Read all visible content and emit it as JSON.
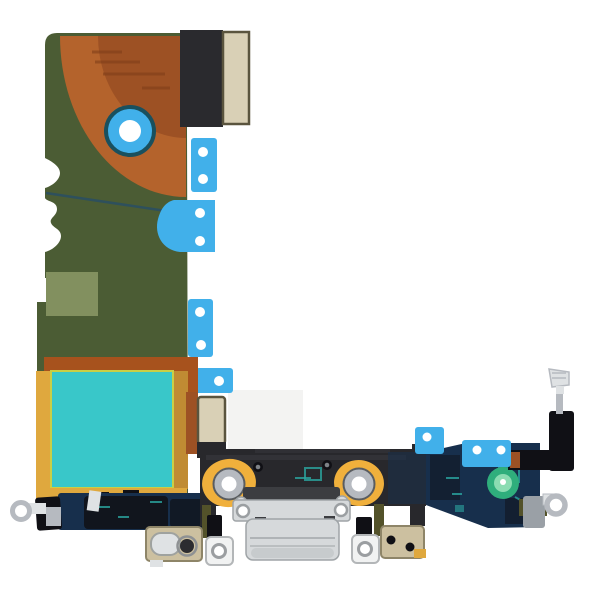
{
  "scene": {
    "description": "Product photo of a phone charging-port dock flex cable replacement part, laid flat on a plain white background",
    "object": "charging-port-flex-cable-assembly"
  },
  "palette": {
    "white": "#ffffff",
    "boardGreen": "#4b5c34",
    "sageGreen": "#82905f",
    "copperOuter": "#b4632c",
    "copperInner": "#9d5124",
    "copperDash": "#7c3d17",
    "traceTeal": "#2e505c",
    "tabBlue": "#41b0ea",
    "holeRim": "#19505e",
    "connectorBlack": "#2a2a2e",
    "tanPad": "#d9d0b6",
    "tanEdge": "#5a543e",
    "rust": "#a7521d",
    "gold": "#dfa83e",
    "goldDark": "#c08b33",
    "tealShield": "#39c7c9",
    "tealEdge": "#c9cf45",
    "navyFlex": "#172f4c",
    "inkBlack": "#101015",
    "tealMark": "#2ba5a0",
    "bracketGray": "#28282c",
    "bracketHighlight": "#45454c",
    "grommetGold": "#f0b03c",
    "silver": "#b6bac0",
    "silverLight": "#dfe2e4",
    "steel": "#9aa0a6",
    "lightningGray": "#d6d9db",
    "lightningEdge": "#9fa4a7",
    "lightningDark": "#3c3d41",
    "olive": "#53522a",
    "tanBracket": "#ccc0a0",
    "tanBracketEdge": "#8e8568",
    "padGreen": "#2fae7c",
    "padGreenLight": "#8bdcb2",
    "shadowGray": "#f3f3f2",
    "whiteTab": "#f1f2f2",
    "whiteTabEdge": "#b3b6b8"
  },
  "parts": [
    {
      "id": "main-flex-board",
      "label": "Green flex PCB body"
    },
    {
      "id": "copper-coil-area",
      "label": "Copper coil quarter-circle region"
    },
    {
      "id": "alignment-hole",
      "label": "Blue ringed alignment hole"
    },
    {
      "id": "board-connector",
      "label": "Black board-to-board connector with tan contact pad"
    },
    {
      "id": "adhesive-tabs",
      "label": "Blue adhesive pull tabs with holes"
    },
    {
      "id": "emi-shield",
      "label": "Teal EMI shield square with gold border"
    },
    {
      "id": "mid-connector",
      "label": "Tan mid connector block"
    },
    {
      "id": "bottom-bracket",
      "label": "Black dock bracket"
    },
    {
      "id": "screw-grommets",
      "label": "Gold screw grommets with silver rings"
    },
    {
      "id": "lightning-connector",
      "label": "Silver lightning charging port"
    },
    {
      "id": "left-microphone",
      "label": "Left microphone and cable"
    },
    {
      "id": "right-microphone",
      "label": "Right microphone and cable"
    },
    {
      "id": "screw-tab-left",
      "label": "White screw tab left"
    },
    {
      "id": "screw-tab-right",
      "label": "White screw tab right"
    },
    {
      "id": "audio-bracket",
      "label": "Tan audio jack bracket"
    },
    {
      "id": "right-bracket",
      "label": "Tan screw bracket right"
    },
    {
      "id": "left-eyelet",
      "label": "Silver ground eyelet left"
    },
    {
      "id": "right-eyelet",
      "label": "Silver ground eyelet right"
    },
    {
      "id": "antenna-arm",
      "label": "Black antenna arm with silver screw contact"
    },
    {
      "id": "ground-pad",
      "label": "Green circular grounding pad"
    },
    {
      "id": "navy-flex",
      "label": "Dark navy flex ribbon sections"
    }
  ]
}
